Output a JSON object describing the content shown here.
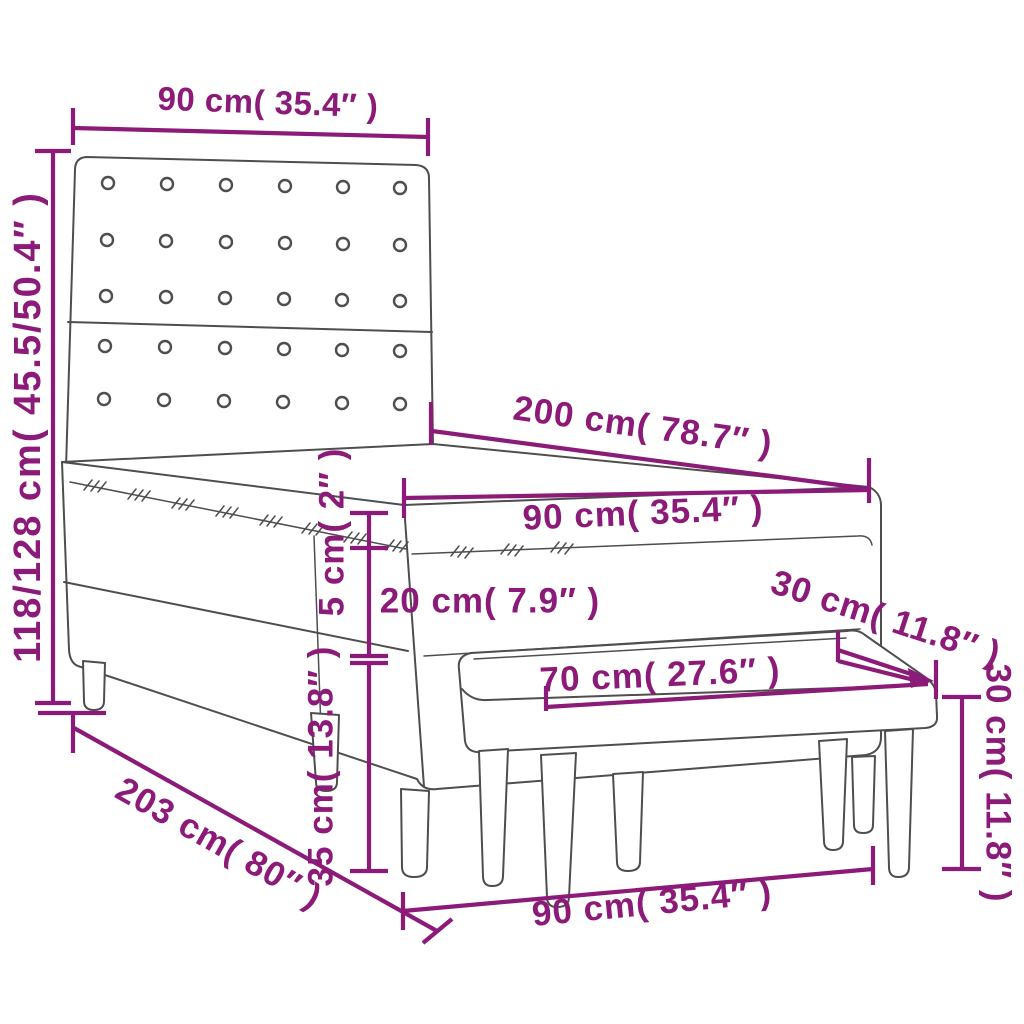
{
  "colors": {
    "dimension": "#8c1a78",
    "line_art": "#4e4e4e",
    "background": "#ffffff"
  },
  "diagram": {
    "type": "furniture-dimension-diagram",
    "subject": "Box spring bed with tufted headboard, mattress topper and upholstered bench",
    "dims": {
      "headboard_width": "90 cm( 35.4″ )",
      "headboard_height": "118/128 cm( 45.5/50.4″ )",
      "bed_length": "200 cm( 78.7″ )",
      "mattress_width": "90 cm( 35.4″ )",
      "topper_thickness": "5 cm( 2″ )",
      "mattress_height": "20 cm( 7.9″ )",
      "frame_height": "35 cm( 13.8″ )",
      "bed_total_length": "203 cm( 80″ )",
      "bench_width": "70 cm( 27.6″ )",
      "bench_depth": "30 cm( 11.8″ )",
      "bench_height": "30 cm( 11.8″ )",
      "bench_length": "90 cm( 35.4″ )"
    }
  }
}
